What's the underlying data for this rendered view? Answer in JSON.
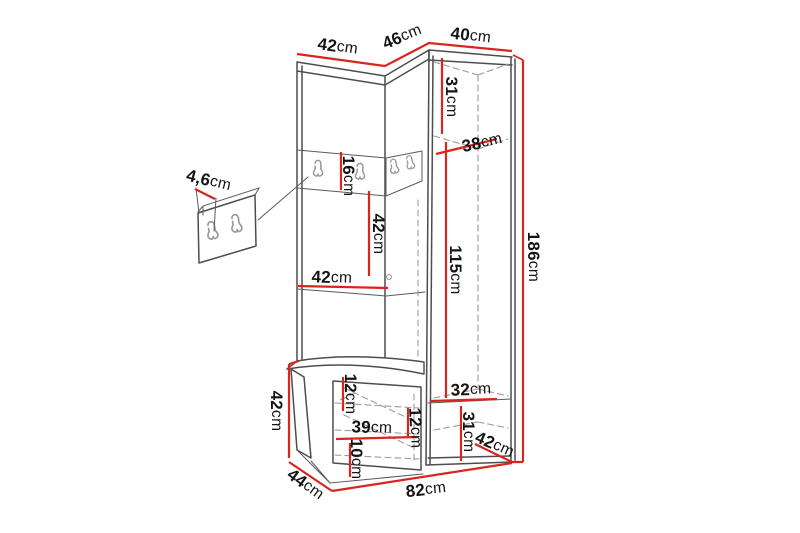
{
  "diagram": {
    "title": "hallway corner wardrobe with bench - dimension drawing",
    "type": "furniture-dimension-diagram",
    "measurement_unit": "cm",
    "colors": {
      "background": "#ffffff",
      "outline": "#4d4d4d",
      "hidden_edge": "#9c9c9c",
      "dimension_line": "#d9251d",
      "label_text": "#141414",
      "hook": "#9a9a9a"
    },
    "dimensions": {
      "top_left_width": {
        "value": "42",
        "unit": "cm"
      },
      "corner_front_width": {
        "value": "46",
        "unit": "cm"
      },
      "top_right_width": {
        "value": "40",
        "unit": "cm"
      },
      "upper_compartment_height": {
        "value": "31",
        "unit": "cm"
      },
      "upper_shelf_depth": {
        "value": "38",
        "unit": "cm"
      },
      "hook_panel_height": {
        "value": "16",
        "unit": "cm"
      },
      "hook_panel_thickness": {
        "value": "4,6",
        "unit": "cm"
      },
      "niche_height": {
        "value": "42",
        "unit": "cm"
      },
      "niche_width": {
        "value": "42",
        "unit": "cm"
      },
      "hanging_space_height": {
        "value": "115",
        "unit": "cm"
      },
      "total_height": {
        "value": "186",
        "unit": "cm"
      },
      "bench_height": {
        "value": "42",
        "unit": "cm"
      },
      "bench_top_section_height": {
        "value": "12",
        "unit": "cm"
      },
      "drawer_width": {
        "value": "39",
        "unit": "cm"
      },
      "drawer_front_height": {
        "value": "12",
        "unit": "cm"
      },
      "bench_bottom_clearance": {
        "value": "10",
        "unit": "cm"
      },
      "lower_compartment_width": {
        "value": "32",
        "unit": "cm"
      },
      "lower_compartment_height": {
        "value": "31",
        "unit": "cm"
      },
      "wardrobe_side_depth": {
        "value": "42",
        "unit": "cm"
      },
      "bench_depth": {
        "value": "44",
        "unit": "cm"
      },
      "total_width": {
        "value": "82",
        "unit": "cm"
      }
    }
  }
}
